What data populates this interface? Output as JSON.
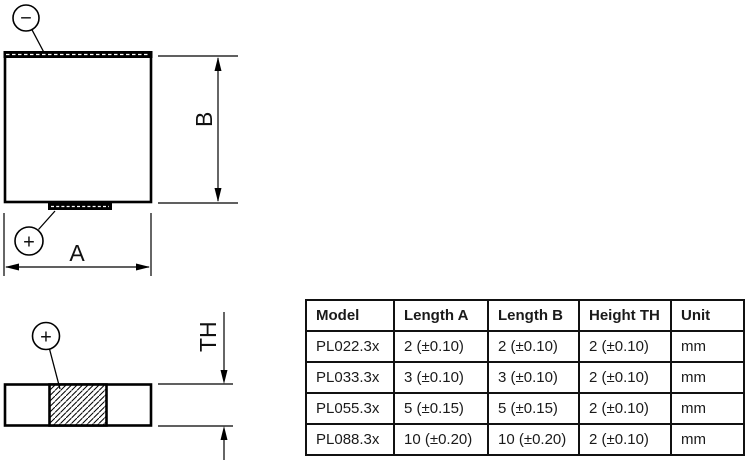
{
  "figures": {
    "front_view": {
      "negative_sign": "−",
      "positive_sign": "+",
      "width_label": "A",
      "height_label": "B"
    },
    "side_view": {
      "positive_sign": "+",
      "thickness_label": "TH"
    }
  },
  "table": {
    "headers": [
      "Model",
      "Length A",
      "Length B",
      "Height TH",
      "Unit"
    ],
    "rows": [
      [
        "PL022.3x",
        "2 (±0.10)",
        "2 (±0.10)",
        "2 (±0.10)",
        "mm"
      ],
      [
        "PL033.3x",
        "3 (±0.10)",
        "3 (±0.10)",
        "2 (±0.10)",
        "mm"
      ],
      [
        "PL055.3x",
        "5 (±0.15)",
        "5 (±0.15)",
        "2 (±0.10)",
        "mm"
      ],
      [
        "PL088.3x",
        "10 (±0.20)",
        "10 (±0.20)",
        "2 (±0.10)",
        "mm"
      ]
    ]
  },
  "colors": {
    "line": "#000000",
    "background": "#ffffff"
  }
}
